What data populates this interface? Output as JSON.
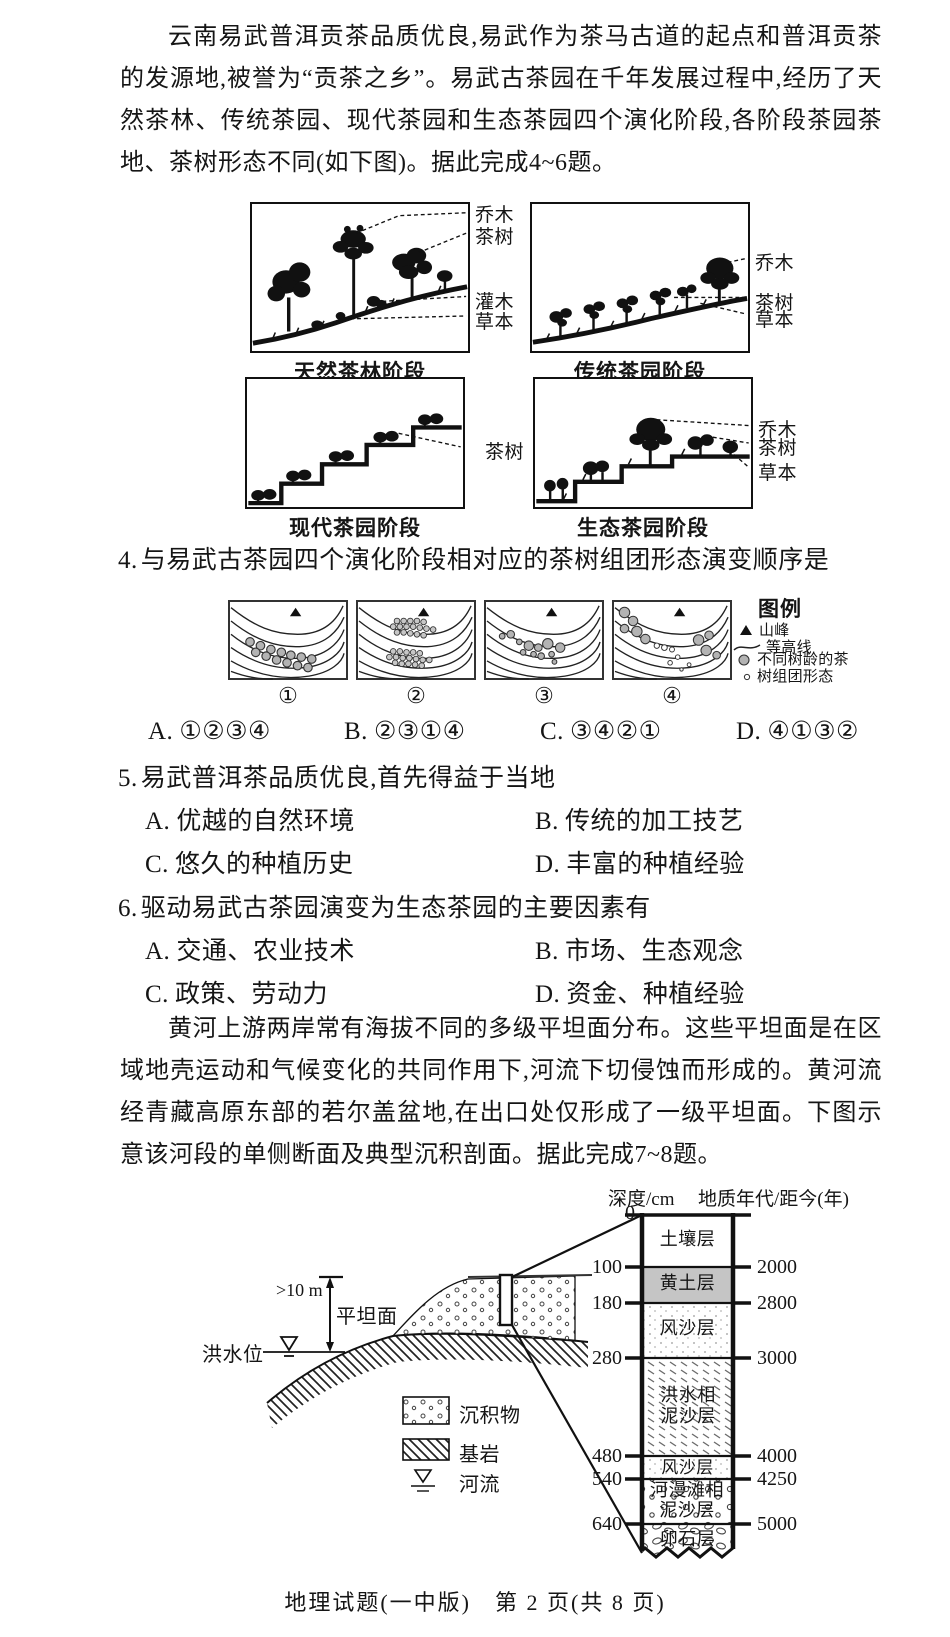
{
  "page": {
    "footer": "地理试题(一中版)　第 2 页(共 8 页)"
  },
  "passage1": "云南易武普洱贡茶品质优良,易武作为茶马古道的起点和普洱贡茶的发源地,被誉为“贡茶之乡”。易武古茶园在千年发展过程中,经历了天然茶林、传统茶园、现代茶园和生态茶园四个演化阶段,各阶段茶园茶地、茶树形态不同(如下图)。据此完成4~6题。",
  "tea_figure": {
    "panel1": {
      "caption": "天然茶林阶段",
      "label_qiaomu": "乔木",
      "label_chashu": "茶树",
      "label_guanmu": "灌木",
      "label_caoben": "草本"
    },
    "panel2": {
      "caption": "传统茶园阶段",
      "label_qiaomu": "乔木",
      "label_chashu": "茶树",
      "label_caoben": "草本"
    },
    "panel3": {
      "caption": "现代茶园阶段",
      "label_chashu": "茶树"
    },
    "panel4": {
      "caption": "生态茶园阶段",
      "label_qiaomu": "乔木",
      "label_chashu": "茶树",
      "label_caoben": "草本"
    }
  },
  "q4": {
    "number": "4.",
    "text": "与易武古茶园四个演化阶段相对应的茶树组团形态演变顺序是",
    "figure": {
      "panel_labels": [
        "①",
        "②",
        "③",
        "④"
      ],
      "legend_title": "图例",
      "legend_peak": "山峰",
      "legend_contour": "等高线",
      "legend_cluster": "不同树龄的茶树组团形态"
    },
    "options": [
      {
        "label": "A.",
        "text": "①②③④"
      },
      {
        "label": "B.",
        "text": "②③①④"
      },
      {
        "label": "C.",
        "text": "③④②①"
      },
      {
        "label": "D.",
        "text": "④①③②"
      }
    ]
  },
  "q5": {
    "number": "5.",
    "text": "易武普洱茶品质优良,首先得益于当地",
    "options": [
      {
        "label": "A.",
        "text": "优越的自然环境"
      },
      {
        "label": "B.",
        "text": "传统的加工技艺"
      },
      {
        "label": "C.",
        "text": "悠久的种植历史"
      },
      {
        "label": "D.",
        "text": "丰富的种植经验"
      }
    ]
  },
  "q6": {
    "number": "6.",
    "text": "驱动易武古茶园演变为生态茶园的主要因素有",
    "options": [
      {
        "label": "A.",
        "text": "交通、农业技术"
      },
      {
        "label": "B.",
        "text": "市场、生态观念"
      },
      {
        "label": "C.",
        "text": "政策、劳动力"
      },
      {
        "label": "D.",
        "text": "资金、种植经验"
      }
    ]
  },
  "passage2": "黄河上游两岸常有海拔不同的多级平坦面分布。这些平坦面是在区域地壳运动和气候变化的共同作用下,河流下切侵蚀而形成的。黄河流经青藏高原东部的若尔盖盆地,在出口处仅形成了一级平坦面。下图示意该河段的单侧断面及典型沉积剖面。据此完成7~8题。",
  "river_figure": {
    "flood_level_label": "洪水位",
    "height_label": ">10 m",
    "flat_surface_label": "平坦面",
    "legend": {
      "sediment": "沉积物",
      "bedrock": "基岩",
      "river": "河流"
    },
    "column": {
      "depth_header": "深度/cm",
      "age_header": "地质年代/距今(年)",
      "depths": [
        "0",
        "100",
        "180",
        "280",
        "480",
        "540",
        "640"
      ],
      "ages": [
        "2000",
        "2800",
        "3000",
        "4000",
        "4250",
        "5000"
      ],
      "layers": [
        "土壤层",
        "黄土层",
        "风沙层",
        "洪水相泥沙层",
        "风沙层",
        "河漫滩相泥沙层",
        "卵石层"
      ]
    }
  }
}
